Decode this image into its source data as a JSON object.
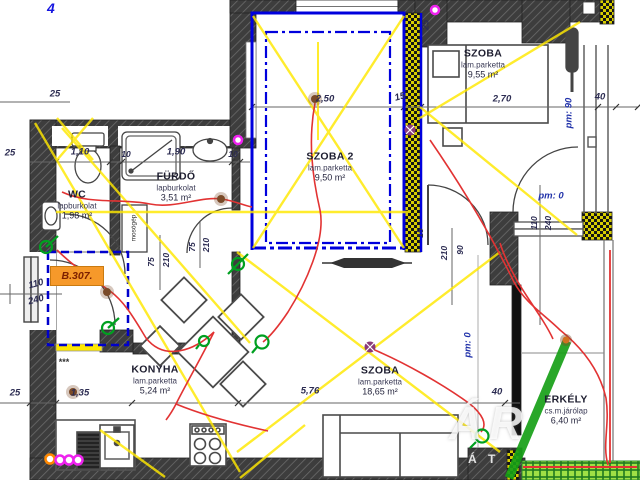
{
  "sheet": {
    "number": "4"
  },
  "unit": {
    "badge": "B.307."
  },
  "rooms": [
    {
      "id": "wc",
      "name": "WC",
      "floor": "lapburkolat",
      "area": "1,98 m²"
    },
    {
      "id": "furdo",
      "name": "FÜRDŐ",
      "floor": "lapburkolat",
      "area": "3,51 m²"
    },
    {
      "id": "szoba2",
      "name": "SZOBA 2",
      "floor": "lam.parketta",
      "area": "9,50 m²"
    },
    {
      "id": "szoba-top",
      "name": "SZOBA",
      "floor": "lam.parketta",
      "area": "9,55 m²"
    },
    {
      "id": "konyha",
      "name": "KONYHA",
      "floor": "lam.parketta",
      "area": "5,24 m²"
    },
    {
      "id": "szoba-nagy",
      "name": "SZOBA",
      "floor": "lam.parketta",
      "area": "18,65 m²"
    },
    {
      "id": "erkely",
      "name": "ERKÉLY",
      "floor": "cs.m.járólap",
      "area": "6,40 m²"
    }
  ],
  "fixtures": {
    "washing_machine": "mosógép"
  },
  "dims": {
    "top_25": "25",
    "left_25": "25",
    "w_110": "1,10",
    "t_10a": "10",
    "w_190": "1,90",
    "t_10b": "10",
    "szoba2_w": "2,50",
    "wall_15a": "15",
    "szoba_w": "2,70",
    "win_40": "40",
    "wall_25v": "25",
    "pm90": "pm: 90",
    "pm0_door": "pm: 0",
    "pm0_room": "pm: 0",
    "wc_door_w": "75",
    "wc_door_h": "210",
    "bath_door_w": "75",
    "bath_door_h": "210",
    "hall_door_w": "90",
    "hall_door_h": "210",
    "wall_15b": "15",
    "balc_door_w": "110",
    "balc_door_h": "240",
    "entry_door_w": "110",
    "entry_door_h": "240",
    "b_25": "25",
    "b_135": "1,35",
    "b_576": "5,76",
    "b_40": "40",
    "stars": "***"
  },
  "watermark": {
    "big": "ÁR",
    "small": "Á T"
  },
  "colors": {
    "wall": "#3d3d3d",
    "plan_blue": "#0000cc",
    "markup_yellow": "#ffe800",
    "markup_red": "#e23333",
    "markup_green": "#00a020",
    "magenta": "#ee22ee",
    "badge_orange": "#f6992a",
    "insulation_yellow": "#d8ce00",
    "balcony_green": "#9fe045"
  }
}
